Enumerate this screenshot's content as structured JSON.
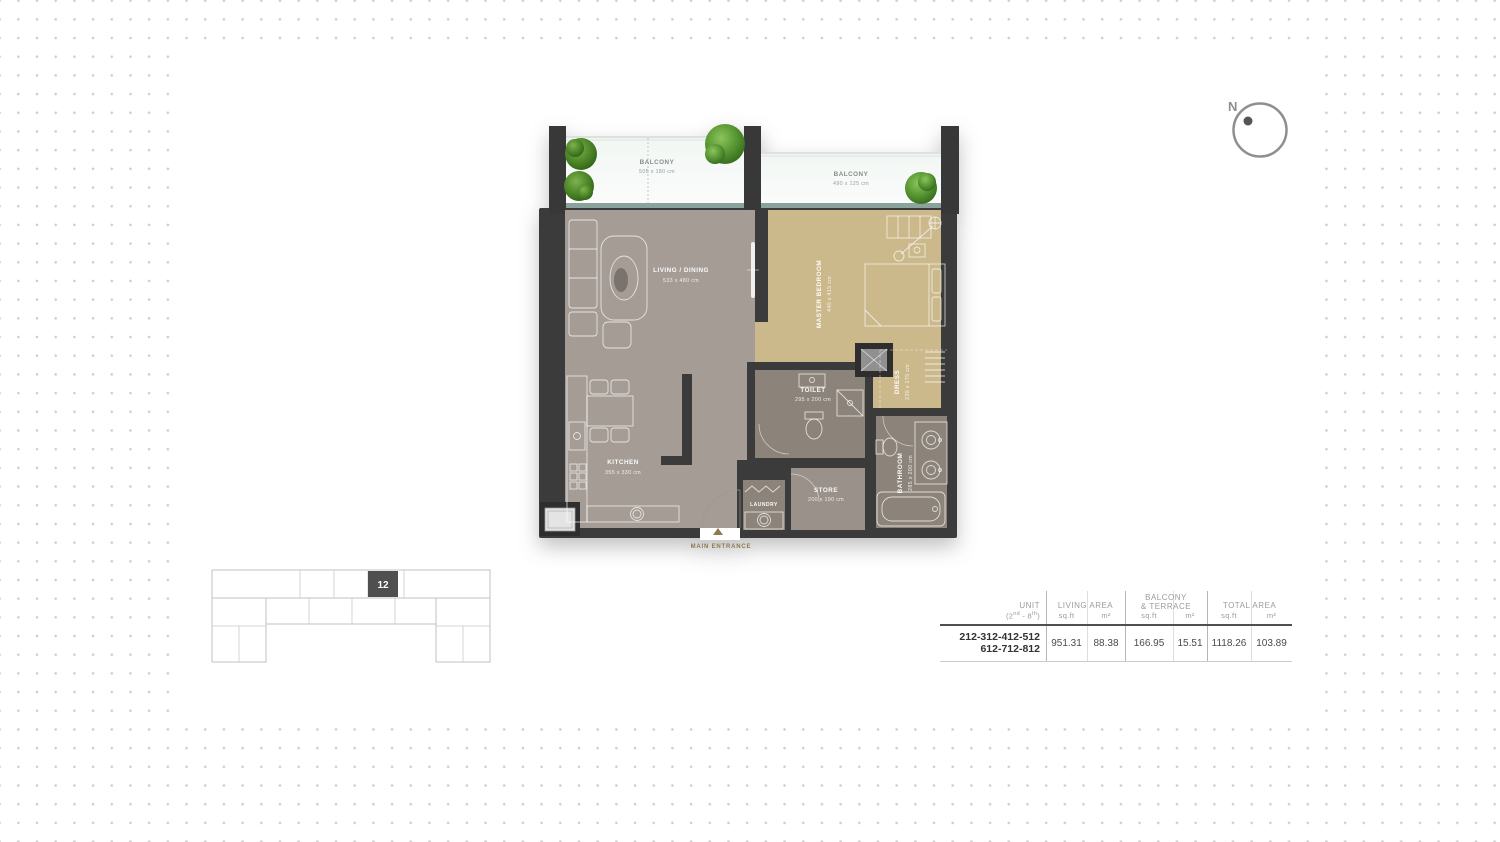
{
  "compass": {
    "north_label": "N"
  },
  "floor_plan": {
    "balcony_1": {
      "name": "BALCONY",
      "dims": "505 x 180 cm"
    },
    "balcony_2": {
      "name": "BALCONY",
      "dims": "490 x 125 cm"
    },
    "living_dining": {
      "name": "LIVING / DINING",
      "dims": "533 x 480 cm"
    },
    "master_bedroom": {
      "name": "MASTER BEDROOM",
      "dims": "440 x 415 cm"
    },
    "kitchen": {
      "name": "KITCHEN",
      "dims": "355 x 330 cm"
    },
    "toilet": {
      "name": "TOILET",
      "dims": "295 x 200 cm"
    },
    "dress": {
      "name": "DRESS",
      "dims": "230 x 175 cm"
    },
    "bathroom": {
      "name": "BATHROOM",
      "dims": "285 x 200 cm"
    },
    "store": {
      "name": "STORE",
      "dims": "200 x 190 cm"
    },
    "laundry": {
      "name": "LAUNDRY"
    },
    "main_entrance_label": "MAIN ENTRANCE"
  },
  "key_plan": {
    "highlighted_unit": "12"
  },
  "area_table": {
    "headers": {
      "unit_line1": "UNIT",
      "unit_line2": {
        "p1": "(2",
        "sup1": "nd",
        "p2": " - 8",
        "sup2": "th",
        "p3": ")"
      },
      "living_area": "LIVING AREA",
      "balcony_line1": "BALCONY",
      "balcony_line2": "& TERRACE",
      "total_area": "TOTAL AREA",
      "sqft": "sq.ft",
      "sqm": "m²"
    },
    "row": {
      "unit_line1": "212-312-412-512",
      "unit_line2": "612-712-812",
      "living_sqft": "951.31",
      "living_sqm": "88.38",
      "balcony_sqft": "166.95",
      "balcony_sqm": "15.51",
      "total_sqft": "1118.26",
      "total_sqm": "103.89"
    }
  },
  "colors": {
    "wall": "#3b3b3b",
    "living_floor": "#a59c95",
    "bedroom_floor": "#cbb88b",
    "wet_area_floor": "#8c847a",
    "store_floor": "#99918a",
    "balcony_edge": "#8ba39d",
    "entrance_gold": "#8d7a4e",
    "highlighted_unit_fill": "#4f4f4f",
    "dot_grid": "#cfcfcf"
  }
}
